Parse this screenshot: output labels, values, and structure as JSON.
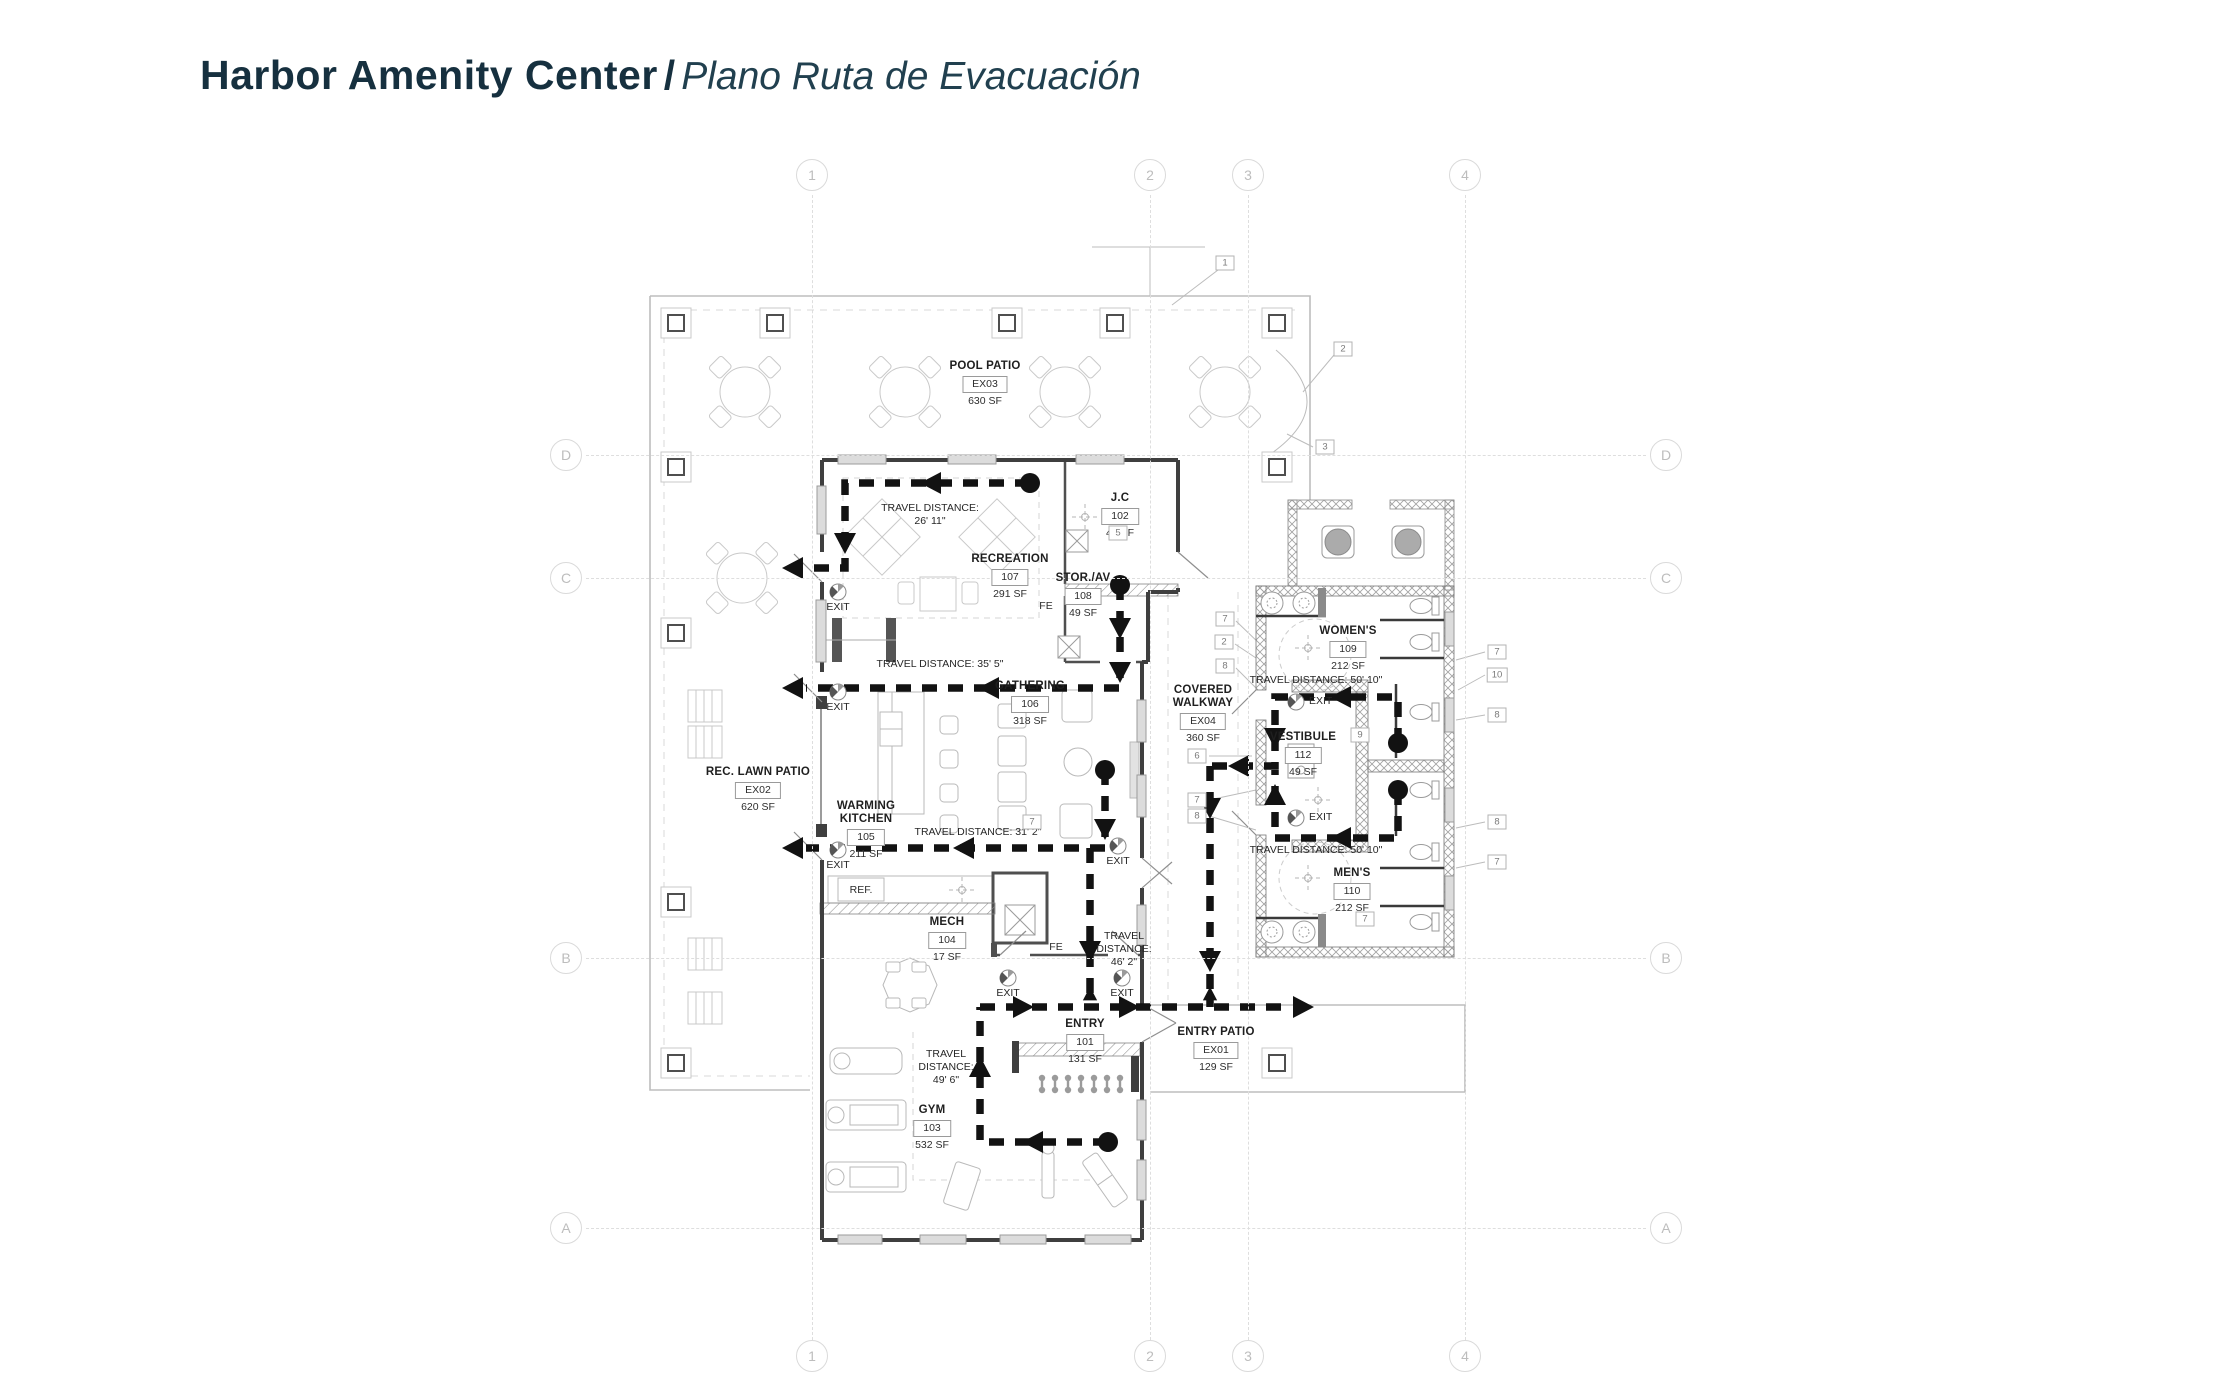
{
  "title": {
    "main": "Harbor Amenity Center",
    "sep": "/",
    "sub": "Plano Ruta de Evacuación"
  },
  "grid": {
    "columns": [
      {
        "label": "1",
        "x": 812
      },
      {
        "label": "2",
        "x": 1150
      },
      {
        "label": "3",
        "x": 1248
      },
      {
        "label": "4",
        "x": 1465
      }
    ],
    "rows": [
      {
        "label": "D",
        "y": 455
      },
      {
        "label": "C",
        "y": 578
      },
      {
        "label": "B",
        "y": 958
      },
      {
        "label": "A",
        "y": 1228
      }
    ]
  },
  "rooms": [
    {
      "key": "pool-patio",
      "name": "POOL PATIO",
      "number": "EX03",
      "area": "630 SF",
      "x": 985,
      "y": 360
    },
    {
      "key": "jc",
      "name": "J.C",
      "number": "102",
      "area": "46 SF",
      "x": 1120,
      "y": 492
    },
    {
      "key": "recreation",
      "name": "RECREATION",
      "number": "107",
      "area": "291 SF",
      "x": 1010,
      "y": 553
    },
    {
      "key": "stor-av",
      "name": "STOR./AV",
      "number": "108",
      "area": "49 SF",
      "x": 1083,
      "y": 572
    },
    {
      "key": "gathering",
      "name": "GATHERING",
      "number": "106",
      "area": "318 SF",
      "x": 1030,
      "y": 680
    },
    {
      "key": "covered-walkway",
      "name": "COVERED\nWALKWAY",
      "number": "EX04",
      "area": "360 SF",
      "x": 1203,
      "y": 684
    },
    {
      "key": "rec-lawn-patio",
      "name": "REC. LAWN PATIO",
      "number": "EX02",
      "area": "620 SF",
      "x": 758,
      "y": 766
    },
    {
      "key": "warming-kitchen",
      "name": "WARMING\nKITCHEN",
      "number": "105",
      "area": "211 SF",
      "x": 866,
      "y": 800
    },
    {
      "key": "mech",
      "name": "MECH",
      "number": "104",
      "area": "17 SF",
      "x": 947,
      "y": 916
    },
    {
      "key": "entry",
      "name": "ENTRY",
      "number": "101",
      "area": "131 SF",
      "x": 1085,
      "y": 1018
    },
    {
      "key": "entry-patio",
      "name": "ENTRY PATIO",
      "number": "EX01",
      "area": "129 SF",
      "x": 1216,
      "y": 1026
    },
    {
      "key": "gym",
      "name": "GYM",
      "number": "103",
      "area": "532 SF",
      "x": 932,
      "y": 1104
    },
    {
      "key": "womens",
      "name": "WOMEN'S",
      "number": "109",
      "area": "212 SF",
      "x": 1348,
      "y": 625
    },
    {
      "key": "vestibule",
      "name": "VESTIBULE",
      "number": "112",
      "area": "49 SF",
      "x": 1303,
      "y": 731
    },
    {
      "key": "mens",
      "name": "MEN'S",
      "number": "110",
      "area": "212 SF",
      "x": 1352,
      "y": 867
    }
  ],
  "travel_labels": [
    {
      "key": "rec",
      "lines": "TRAVEL DISTANCE:\n26' 11\"",
      "x": 930,
      "y": 502
    },
    {
      "key": "gathering",
      "lines": "TRAVEL DISTANCE: 35' 5\"",
      "x": 940,
      "y": 658
    },
    {
      "key": "kitchen",
      "lines": "TRAVEL DISTANCE: 31' 2\"",
      "x": 978,
      "y": 826
    },
    {
      "key": "entry",
      "lines": "TRAVEL\nDISTANCE:\n46' 2\"",
      "x": 1124,
      "y": 930
    },
    {
      "key": "gym",
      "lines": "TRAVEL\nDISTANCE:\n49' 6\"",
      "x": 946,
      "y": 1048
    },
    {
      "key": "womens",
      "lines": "TRAVEL DISTANCE: 50' 10\"",
      "x": 1316,
      "y": 674
    },
    {
      "key": "mens",
      "lines": "TRAVEL DISTANCE: 50' 10\"",
      "x": 1316,
      "y": 844
    }
  ],
  "exits": [
    {
      "label": "EXIT",
      "x": 838,
      "y": 592,
      "side": "below"
    },
    {
      "label": "EXIT",
      "x": 838,
      "y": 692,
      "side": "below"
    },
    {
      "label": "EXIT",
      "x": 838,
      "y": 850,
      "side": "below"
    },
    {
      "label": "EXIT",
      "x": 1118,
      "y": 846,
      "side": "below"
    },
    {
      "label": "EXIT",
      "x": 1008,
      "y": 978,
      "side": "below"
    },
    {
      "label": "EXIT",
      "x": 1122,
      "y": 978,
      "side": "below"
    },
    {
      "label": "EXIT",
      "x": 1296,
      "y": 702,
      "side": "right"
    },
    {
      "label": "EXIT",
      "x": 1296,
      "y": 818,
      "side": "right"
    }
  ],
  "keynotes": [
    {
      "n": "1",
      "x": 1225,
      "y": 263
    },
    {
      "n": "2",
      "x": 1343,
      "y": 349
    },
    {
      "n": "3",
      "x": 1325,
      "y": 447
    },
    {
      "n": "5",
      "x": 1118,
      "y": 533
    },
    {
      "n": "7",
      "x": 1225,
      "y": 619
    },
    {
      "n": "2",
      "x": 1224,
      "y": 642
    },
    {
      "n": "8",
      "x": 1225,
      "y": 666
    },
    {
      "n": "6",
      "x": 1197,
      "y": 756
    },
    {
      "n": "7",
      "x": 1197,
      "y": 800
    },
    {
      "n": "8",
      "x": 1197,
      "y": 816
    },
    {
      "n": "9",
      "x": 1360,
      "y": 735
    },
    {
      "n": "7",
      "x": 1497,
      "y": 652
    },
    {
      "n": "10",
      "x": 1497,
      "y": 675
    },
    {
      "n": "8",
      "x": 1497,
      "y": 715
    },
    {
      "n": "8",
      "x": 1497,
      "y": 822
    },
    {
      "n": "7",
      "x": 1497,
      "y": 862
    },
    {
      "n": "7",
      "x": 1365,
      "y": 919
    },
    {
      "n": "7",
      "x": 1032,
      "y": 822
    }
  ],
  "misc_labels": [
    {
      "key": "fe-recreation",
      "text": "FE",
      "x": 1046,
      "y": 606
    },
    {
      "key": "fe-mech",
      "text": "FE",
      "x": 1056,
      "y": 947
    },
    {
      "key": "refrigerator",
      "text": "REF.",
      "x": 861,
      "y": 890
    }
  ]
}
